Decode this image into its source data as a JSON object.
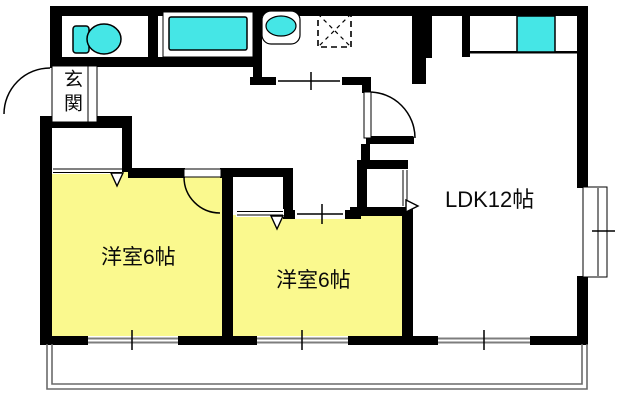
{
  "rooms": {
    "genkan": {
      "label": "玄関"
    },
    "bedroom1": {
      "label": "洋室6帖"
    },
    "bedroom2": {
      "label": "洋室6帖"
    },
    "ldk": {
      "label": "LDK12帖"
    }
  },
  "colors": {
    "room_fill": "#FAF98E",
    "fixture_fill": "#45E6E6",
    "wall": "#000000",
    "window_line": "#7d7d7d",
    "balcony_line": "#6a6a6a"
  },
  "fixtures": [
    "toilet",
    "bathtub",
    "washbasin",
    "washing-machine-space",
    "kitchen-sink",
    "kitchen-counter",
    "bay-window",
    "balcony",
    "entrance-door",
    "closet"
  ]
}
